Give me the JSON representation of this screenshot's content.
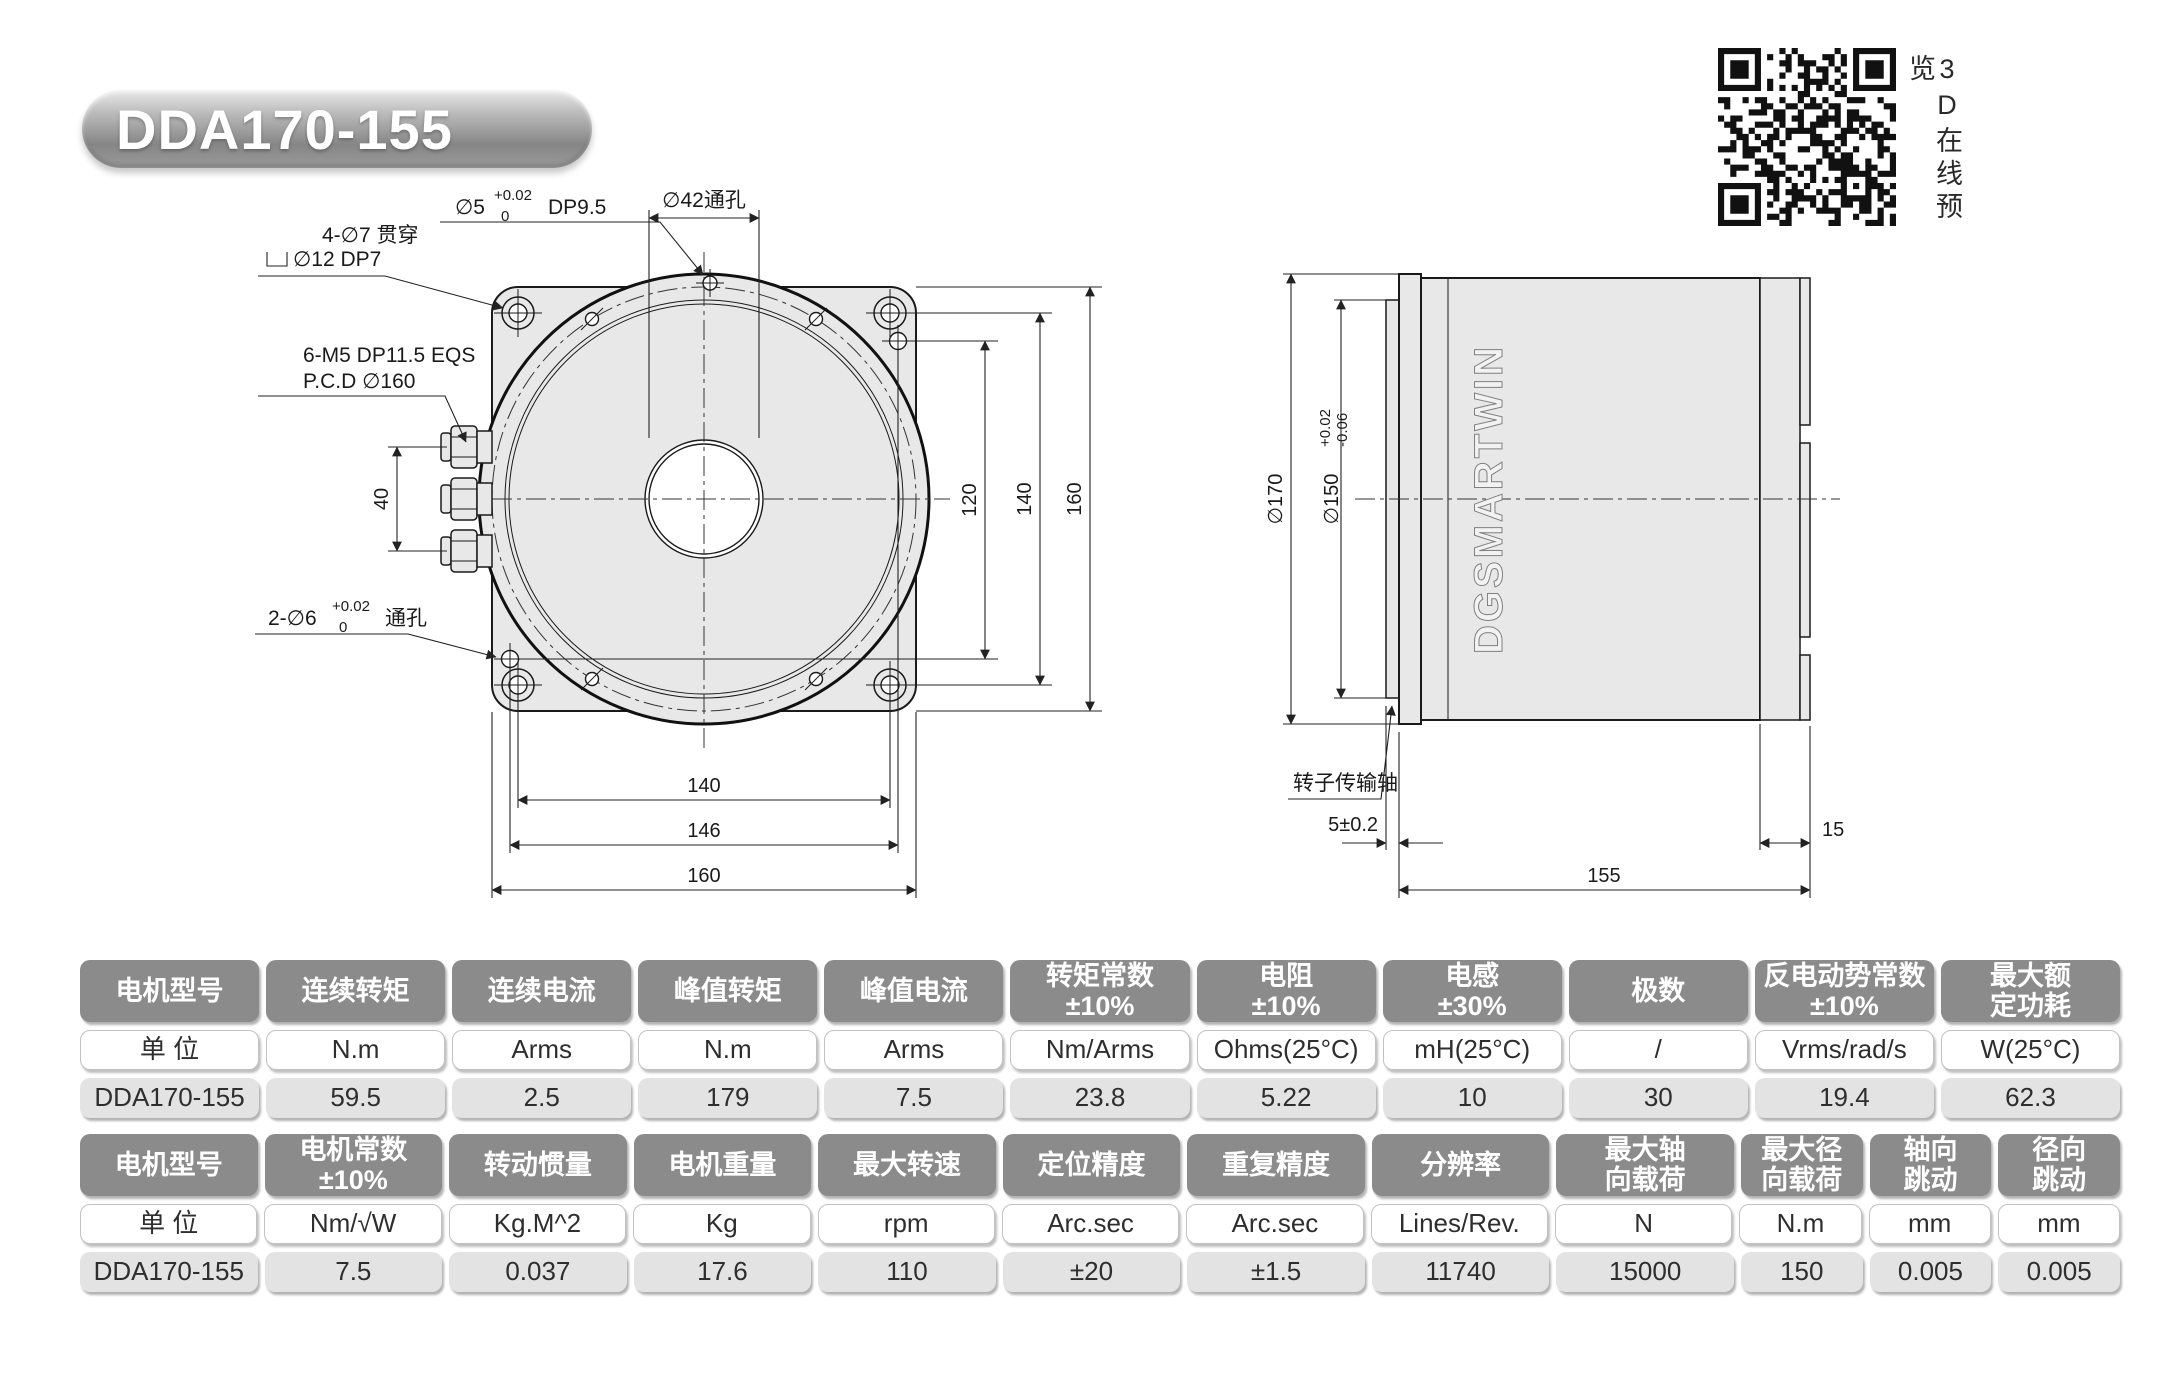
{
  "page": {
    "title": "DDA170-155",
    "qr_caption": "3D在线预览"
  },
  "front_view": {
    "dowel_hole": {
      "prefix": "∅5",
      "tol_upper": "+0.02",
      "tol_lower": "0",
      "suffix": "DP9.5"
    },
    "center_hole": "∅42通孔",
    "corner_holes_line1": "4-∅7 贯穿",
    "corner_holes_line2": "∅12 DP7",
    "tap_holes_line1": "6-M5  DP11.5  EQS",
    "tap_holes_line2": "P.C.D ∅160",
    "index_holes": {
      "prefix": "2-∅6",
      "tol_upper": "+0.02",
      "tol_lower": "0",
      "suffix": "通孔"
    },
    "dims": {
      "connector_pitch": "40",
      "index_v": "120",
      "holes_v": "140",
      "flange_v": "160",
      "holes_h": "140",
      "index_h": "146",
      "flange_h": "160"
    }
  },
  "side_view": {
    "flange_diameter": "∅170",
    "spigot_diameter": {
      "prefix": "∅150",
      "tol_upper": "+0.02",
      "tol_lower": "-0.06"
    },
    "logo": "DGSMARTWIN",
    "shaft_label": "转子传输轴",
    "dims": {
      "spigot_depth": "5±0.2",
      "body_length": "155",
      "end_width": "15"
    }
  },
  "spec_table_1": {
    "headers": [
      "电机型号",
      "连续转矩",
      "连续电流",
      "峰值转矩",
      "峰值电流",
      "转矩常数\n±10%",
      "电阻\n±10%",
      "电感\n±30%",
      "极数",
      "反电动势常数\n±10%",
      "最大额\n定功耗"
    ],
    "units": [
      "单 位",
      "N.m",
      "Arms",
      "N.m",
      "Arms",
      "Nm/Arms",
      "Ohms(25°C)",
      "mH(25°C)",
      "/",
      "Vrms/rad/s",
      "W(25°C)"
    ],
    "values": [
      "DDA170-155",
      "59.5",
      "2.5",
      "179",
      "7.5",
      "23.8",
      "5.22",
      "10",
      "30",
      "19.4",
      "62.3"
    ]
  },
  "spec_table_2": {
    "headers": [
      "电机型号",
      "电机常数\n±10%",
      "转动惯量",
      "电机重量",
      "最大转速",
      "定位精度",
      "重复精度",
      "分辨率",
      "最大轴\n向载荷",
      "最大径\n向载荷",
      "轴向\n跳动",
      "径向\n跳动"
    ],
    "units": [
      "单 位",
      "Nm/√W",
      "Kg.M^2",
      "Kg",
      "rpm",
      "Arc.sec",
      "Arc.sec",
      "Lines/Rev.",
      "N",
      "N.m",
      "mm",
      "mm"
    ],
    "values": [
      "DDA170-155",
      "7.5",
      "0.037",
      "17.6",
      "110",
      "±20",
      "±1.5",
      "11740",
      "15000",
      "150",
      "0.005",
      "0.005"
    ]
  }
}
